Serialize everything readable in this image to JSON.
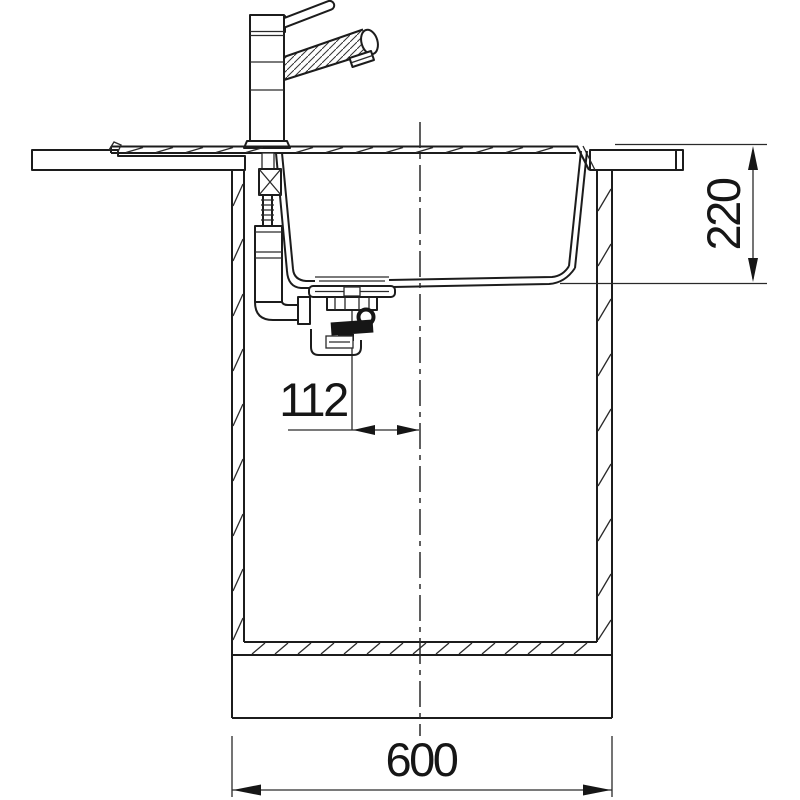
{
  "diagram": {
    "kind": "sink-installation-cross-section",
    "dimensions": {
      "sink_depth_label": "220",
      "drain_offset_label": "112",
      "cabinet_width_label": "600"
    },
    "colors": {
      "line": "#1c1c1c",
      "background": "#ffffff",
      "solid_parts": "#161616"
    }
  }
}
